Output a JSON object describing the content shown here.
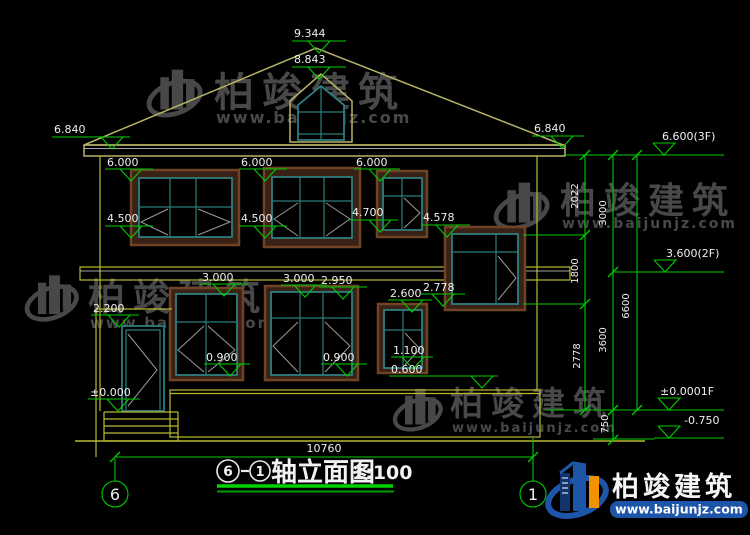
{
  "titlebar": {
    "axis_start": "6",
    "axis_end": "1",
    "name": "轴立面图",
    "scale": "1:100"
  },
  "axes": {
    "left": "6",
    "right": "1"
  },
  "dims": {
    "overall_width": "10760",
    "right_chain": {
      "d2022": "2022",
      "d1800": "1800",
      "d2778": "2778",
      "d3000": "3000",
      "d3600": "3600",
      "d750": "750",
      "d6600": "6600"
    }
  },
  "marks": {
    "m9344": "9.344",
    "m8843": "8.843",
    "m6840l": "6.840",
    "m6840r": "6.840",
    "m6600": "6.600(3F)",
    "m3600": "3.600(2F)",
    "m0000r": "±0.0001F",
    "mneg750": "-0.750",
    "m6000a": "6.000",
    "m6000b": "6.000",
    "m6000c": "6.000",
    "m4500a": "4.500",
    "m4500b": "4.500",
    "m4700": "4.700",
    "m4578": "4.578",
    "m3000a": "3.000",
    "m3000b": "3.000",
    "m2950": "2.950",
    "m2600": "2.600",
    "m2778": "2.778",
    "m2200": "2.200",
    "m0900a": "0.900",
    "m0900b": "0.900",
    "m1100": "1.100",
    "m0600": "0.600",
    "m0000l": "±0.000"
  },
  "watermark": {
    "brand": "柏竣建筑",
    "url": "www.baijunjz.com"
  },
  "logo": {
    "brand": "柏竣建筑",
    "url": "www.baijunjz.com"
  },
  "colors": {
    "line_green": "#00cb00",
    "line_yellow": "#b9b930",
    "window_teal": "#2e7d7d",
    "frame_brown": "#3a2115",
    "brand_blue": "#1d55a8",
    "brand_orange": "#f29200"
  }
}
